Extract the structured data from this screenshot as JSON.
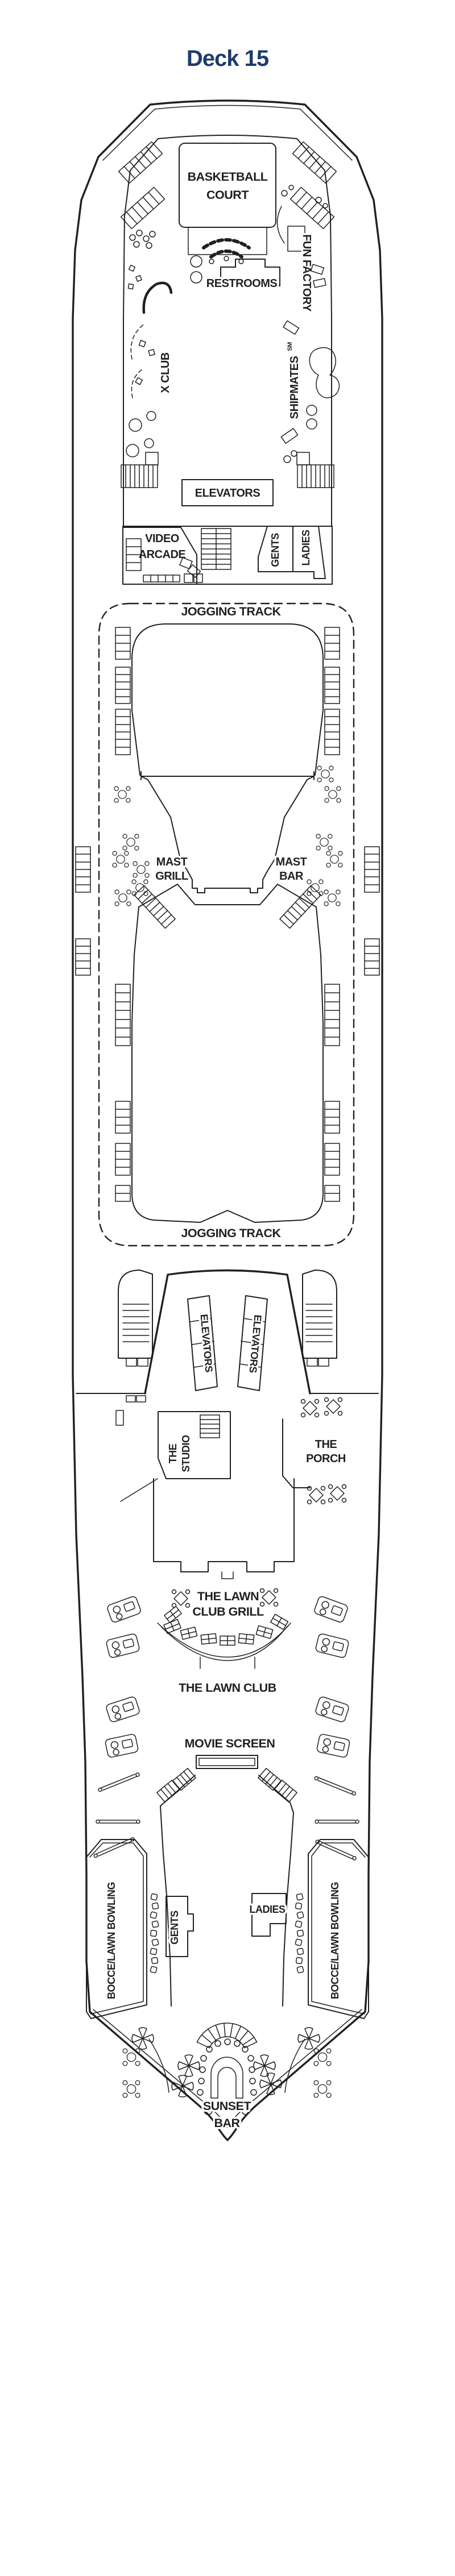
{
  "page": {
    "title": "Deck 15"
  },
  "colors": {
    "ink": "#231f20",
    "title_navy": "#1d3c6d",
    "background": "#ffffff"
  },
  "labels": {
    "title": "Deck 15",
    "basketball": [
      "BASKETBALL",
      "COURT"
    ],
    "restrooms": "RESTROOMS",
    "fun_factory": "FUN FACTORY",
    "x_club": "X CLUB",
    "shipmates": "SHIPMATES",
    "shipmates_sm": "SM",
    "elevators_forward": "ELEVATORS",
    "video_arcade": [
      "VIDEO",
      "ARCADE"
    ],
    "gents_forward": "GENTS",
    "ladies_forward": "LADIES",
    "jogging_track": "JOGGING TRACK",
    "mast_grill": [
      "MAST",
      "GRILL"
    ],
    "mast_bar": [
      "MAST",
      "BAR"
    ],
    "elevators_mid": "ELEVATORS",
    "studio": [
      "THE",
      "STUDIO"
    ],
    "porch": [
      "THE",
      "PORCH"
    ],
    "lawn_club_grill": [
      "THE LAWN",
      "CLUB GRILL"
    ],
    "lawn_club": "THE LAWN CLUB",
    "movie_screen": "MOVIE SCREEN",
    "gents_aft": "GENTS",
    "ladies_aft": "LADIES",
    "bocce_left": "BOCCE/LAWN BOWLING",
    "bocce_right": "BOCCE/LAWN BOWLING",
    "sunset_bar": [
      "SUNSET",
      "BAR"
    ]
  },
  "icons": {
    "deck-chairs-icon": "hatched rack of sun loungers",
    "stairs-icon": "hatched stair flight",
    "table-icon": "round table with four chairs",
    "square-table-icon": "diamond table with four chairs",
    "grill-table-icon": "rectangular divided table",
    "umbrella-icon": "four-petal parasol pinwheel",
    "lounge-icon": "cabana lounger cluster",
    "bench-icon": "double-line bench",
    "chair-icon": "small single chair",
    "stool-icon": "bar stool circle",
    "movie-screen-icon": "outdoor movie screen rectangle",
    "bar-icon": "horseshoe bar counter",
    "fan-canopy-icon": "radial hatched canopy"
  }
}
